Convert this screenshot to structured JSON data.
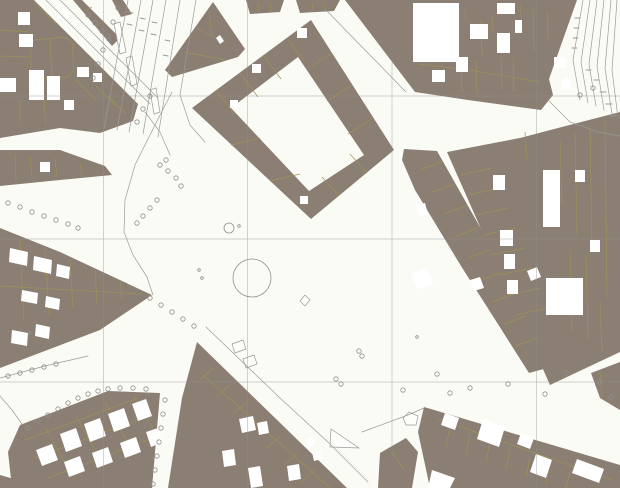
{
  "meta": {
    "width": 620,
    "height": 488,
    "description": "cadastral-city-map"
  },
  "colors": {
    "background": "#fbfbf6",
    "block_fill": "#8b7e73",
    "parcel_line": "#9d9356",
    "street_line": "#9a9a9a",
    "grid_line": "#8f8f8f",
    "building_fill": "#ffffff",
    "island_fill": "#fdfdf9",
    "circle_line": "#909090"
  },
  "grid": {
    "vertical_x": [
      103.5,
      247.5,
      392,
      536.5
    ],
    "horizontal_y": [
      96,
      239,
      382
    ]
  },
  "blocks": [
    {
      "name": "block-topleft-main",
      "points": "0,0 34,0 138,104 133,121 100,133 60,128 0,138"
    },
    {
      "name": "block-topleft-sliver",
      "points": "73,0 82,0 120,38 112,46"
    },
    {
      "name": "block-topleft-sliver2",
      "points": "112,0 123,0 132,14 121,17"
    },
    {
      "name": "block-triangle-top",
      "points": "213,2 245,49 238,57 172,77 165,70"
    },
    {
      "name": "block-ring-place",
      "points": "192,108 311,20 394,150 311,219",
      "hole": "231,108 298,57 364,155 309,191"
    },
    {
      "name": "block-top-strip-1",
      "points": "246,0 284,0 280,12 250,14"
    },
    {
      "name": "block-top-strip-2",
      "points": "296,0 340,0 334,11 300,13"
    },
    {
      "name": "block-topright-main",
      "points": "345,0 577,0 549,79 553,95 541,110 468,100 415,92"
    },
    {
      "name": "block-east-main",
      "points": "447,152 520,138 558,128 620,112 620,352 550,385"
    },
    {
      "name": "block-midright",
      "points": "404,149 437,151 549,349 551,367 529,373 461,266 415,190 402,160"
    },
    {
      "name": "block-bottomright-main",
      "points": "424,407 620,465 620,488 430,488 418,432"
    },
    {
      "name": "block-bottomright-sliver",
      "points": "591,373 620,362 620,410 600,398"
    },
    {
      "name": "block-bottomright-small",
      "points": "380,453 406,438 418,452 412,488 378,488"
    },
    {
      "name": "block-bottomcenter-wedge",
      "points": "197,342 347,488 168,488 182,398"
    },
    {
      "name": "block-bottomleft-main",
      "points": "20,425 108,391 160,393 152,488 12,488 8,452"
    },
    {
      "name": "block-bottomleft-corner",
      "points": "0,475 14,479 12,488 0,488"
    },
    {
      "name": "block-leftwedge-small",
      "points": "0,150 60,150 105,166 112,175 60,180 0,186"
    },
    {
      "name": "block-leftwedge-big",
      "points": "0,228 60,252 152,295 100,330 0,368"
    }
  ],
  "parcel_lines": [
    "34,40 64,37 72,42 74,70 68,77 38,79 31,72 31,45 34,40",
    "50,38 52,77",
    "0,30 28,32",
    "0,56 30,57",
    "34,2 56,24",
    "20,100 20,126",
    "44,100 46,124",
    "76,80 96,100",
    "96,86 116,106",
    "108,96 126,114",
    "216,90 234,114",
    "240,73 258,97",
    "263,55 281,79",
    "287,38 305,62",
    "332,53 307,69",
    "352,85 327,101",
    "373,118 348,134",
    "367,173 350,154",
    "339,196 322,177",
    "231,145 260,138",
    "270,181 300,174",
    "425,10 427,62",
    "440,5 441,58",
    "465,8 466,22",
    "481,20 482,56",
    "492,16 493,31",
    "520,5 521,18",
    "533,8 534,52",
    "547,12 548,40",
    "461,66 462,92",
    "476,60 477,94",
    "501,56 502,90",
    "513,58 514,92",
    "418,64 470,70 540,82",
    "197,28 228,44",
    "184,52 226,60",
    "209,12 212,36",
    "258,3 259,12",
    "270,2 271,12",
    "312,2 313,11",
    "324,2 325,10",
    "84,12 92,7",
    "96,26 104,21",
    "30,156 32,178",
    "55,158 57,177",
    "80,163 82,177",
    "15,154 16,182",
    "20,240 24,322",
    "45,250 49,315",
    "70,260 73,308",
    "95,270 97,303",
    "120,281 122,299",
    "0,286 140,294",
    "25,440 138,398",
    "34,458 148,416",
    "48,478 158,436",
    "45,427 68,468",
    "75,414 98,455",
    "105,402 128,443",
    "133,394 154,430",
    "213,368 200,380",
    "230,385 216,397",
    "247,402 233,414",
    "264,419 250,431",
    "281,436 267,448",
    "298,453 284,465",
    "315,470 301,482",
    "203,375 330,488",
    "460,175 492,168",
    "468,195 500,188",
    "476,215 508,208",
    "484,235 516,228",
    "492,255 524,248",
    "500,275 532,268",
    "508,295 540,288",
    "516,315 548,308",
    "560,140 562,205",
    "575,133 577,235",
    "590,126 592,250",
    "605,120 607,298",
    "570,250 572,332",
    "586,255 588,340",
    "600,300 602,352",
    "525,132 527,160",
    "420,170 442,162",
    "432,192 454,184",
    "444,214 466,206",
    "456,236 478,228",
    "468,258 490,250",
    "480,280 502,272",
    "492,302 514,294",
    "504,324 526,316",
    "516,346 538,338",
    "450,427 446,447",
    "470,434 466,454",
    "490,442 486,462",
    "510,449 506,469",
    "530,457 526,477",
    "550,464 546,484",
    "570,472 566,488",
    "438,419 612,480",
    "600,372 602,396",
    "392,452 404,470"
  ],
  "street_lines": [
    "172,92 155,125 135,165 125,200 124,232 133,255 147,277 153,295",
    "46,0 150,104",
    "60,0 158,98",
    "128,0 104,128",
    "141,0 117,130",
    "153,0 129,132",
    "166,0 143,134",
    "180,0 158,137",
    "196,0 180,95 190,125 205,142",
    "325,9 406,92",
    "206,327 280,398 330,444 368,482",
    "362,432 408,415 424,408",
    "583,0 573,60 580,100",
    "590,0 581,62 588,103",
    "597,0 589,64 596,106",
    "604,0 597,66 604,110",
    "611,0 605,68 612,114",
    "617,0 612,70 618,118",
    "548,100 570,122 598,132 620,136",
    "0,396 12,410 22,424",
    "0,378 45,366 88,356",
    "145,112 160,132 170,155"
  ],
  "tick_marks": [
    "128,12 133,13",
    "127,24 132,25",
    "140,18 145,19",
    "139,30 144,31",
    "152,22 157,23",
    "151,34 156,35",
    "165,40 170,41",
    "163,55 168,56",
    "575,18 580,18",
    "574,28 579,28",
    "573,38 578,38",
    "572,48 577,48",
    "586,70 591,70",
    "594,80 599,80",
    "600,92 606,92",
    "606,104 612,104",
    "610,116 616,116"
  ],
  "buildings": [
    "18,12 30,12 30,25 18,25",
    "57,8 68,8 68,18 57,18",
    "19,34 33,34 33,47 19,47",
    "29,70 44,70 44,100 29,100",
    "47,76 60,76 60,100 47,100",
    "77,67 89,67 89,77 77,77",
    "93,73 102,73 102,82 93,82",
    "0,78 16,78 16,92 0,92",
    "64,100 74,100 74,110 64,110",
    "216,38 220,35 224,41 220,44",
    "40,162 50,162 50,172 40,172",
    "252,64 261,64 261,73 252,73",
    "230,100 238,100 238,108 230,108",
    "297,28 307,28 307,38 297,38",
    "300,196 308,196 308,204 300,204",
    "413,3 459,3 459,62 413,62",
    "470,24 488,24 488,39 470,39",
    "497,33 510,33 510,53 497,53",
    "515,20 522,20 522,33 515,33",
    "554,57 565,57 565,68 554,68",
    "562,78 571,78 571,89 562,89",
    "456,57 468,57 468,72 456,72",
    "432,70 445,70 445,82 432,82",
    "497,3 515,3 515,14 497,14",
    "543,170 560,170 560,227 543,227",
    "493,175 505,175 505,190 493,190",
    "500,230 513,230 513,246 500,246",
    "504,254 515,254 515,269 504,269",
    "507,280 518,280 518,294 507,294",
    "546,278 583,278 583,315 546,315",
    "590,240 600,240 600,252 590,252",
    "575,170 585,170 585,182 575,182",
    "411,273 427,268 433,284 417,289",
    "416,205 425,203 428,214 419,216",
    "527,271 537,267 541,277 531,281",
    "470,280 480,277 484,288 474,291",
    "445,413 459,418 455,430 441,425",
    "483,419 505,427 499,447 477,439",
    "521,433 534,438 530,449 517,444",
    "536,454 552,460 546,478 530,472",
    "577,459 604,469 599,483 572,473",
    "432,470 455,478 450,488 428,488",
    "239,419 253,416 256,430 242,433",
    "257,423 267,421 269,433 259,435",
    "222,451 234,449 236,465 224,467",
    "248,468 260,466 263,486 251,488",
    "287,466 299,464 301,479 289,481",
    "312,452 320,450 322,459 314,461",
    "306,439 313,437 315,445 308,447",
    "60,434 76,428 82,446 66,452",
    "84,424 100,418 106,436 90,442",
    "108,414 124,408 130,426 114,432",
    "132,404 146,399 152,416 138,421",
    "36,450 52,444 58,460 42,466",
    "64,462 80,456 85,471 69,477",
    "92,453 108,447 113,462 97,468",
    "120,443 136,437 141,452 125,458",
    "146,432 158,428 163,442 151,447",
    "10,248 28,252 27,266 9,262",
    "34,256 52,260 51,274 33,270",
    "57,264 70,267 69,279 56,276",
    "22,290 38,293 37,304 21,301",
    "46,296 60,299 59,310 45,307",
    "12,330 28,333 27,346 11,343",
    "36,324 50,327 49,339 35,336"
  ],
  "islands": [
    "114,24 120,22 126,52 120,54",
    "126,58 132,56 137,84 131,86",
    "150,90 156,88 160,112 154,114",
    "232,344 243,340 246,349 235,353",
    "243,359 254,355 257,364 246,368",
    "403,418 409,412 418,416 416,425 406,425",
    "331,429 359,448 330,447",
    "300,301 305,295 310,300 305,306"
  ],
  "tree_circles": [
    [
      88,
      15
    ],
    [
      95,
      23
    ],
    [
      102,
      31
    ],
    [
      109,
      39
    ],
    [
      118,
      8
    ],
    [
      113,
      22
    ],
    [
      108,
      36
    ],
    [
      103,
      50
    ],
    [
      98,
      64
    ],
    [
      93,
      78
    ],
    [
      160,
      165
    ],
    [
      168,
      171
    ],
    [
      176,
      178
    ],
    [
      181,
      186
    ],
    [
      157,
      200
    ],
    [
      150,
      208
    ],
    [
      143,
      216
    ],
    [
      137,
      223
    ],
    [
      166,
      160
    ],
    [
      8,
      203
    ],
    [
      20,
      207
    ],
    [
      32,
      212
    ],
    [
      44,
      216
    ],
    [
      56,
      220
    ],
    [
      68,
      224
    ],
    [
      78,
      228
    ],
    [
      150,
      298
    ],
    [
      161,
      305
    ],
    [
      172,
      312
    ],
    [
      183,
      319
    ],
    [
      194,
      326
    ],
    [
      8,
      376
    ],
    [
      20,
      373
    ],
    [
      32,
      370
    ],
    [
      44,
      367
    ],
    [
      56,
      364
    ],
    [
      28,
      428
    ],
    [
      38,
      421
    ],
    [
      48,
      415
    ],
    [
      58,
      409
    ],
    [
      68,
      403
    ],
    [
      78,
      398
    ],
    [
      88,
      394
    ],
    [
      98,
      391
    ],
    [
      108,
      389
    ],
    [
      120,
      388
    ],
    [
      133,
      388
    ],
    [
      146,
      389
    ],
    [
      165,
      400
    ],
    [
      163,
      414
    ],
    [
      161,
      428
    ],
    [
      159,
      442
    ],
    [
      157,
      456
    ],
    [
      155,
      470
    ],
    [
      153,
      484
    ],
    [
      336,
      379
    ],
    [
      341,
      384
    ],
    [
      359,
      351
    ],
    [
      362,
      356
    ],
    [
      403,
      390
    ],
    [
      437,
      374
    ],
    [
      450,
      393
    ],
    [
      470,
      388
    ],
    [
      508,
      384
    ],
    [
      545,
      394
    ],
    [
      566,
      373
    ],
    [
      600,
      382
    ],
    [
      611,
      397
    ],
    [
      593,
      88
    ],
    [
      580,
      95
    ],
    [
      150,
      96
    ],
    [
      143,
      109
    ],
    [
      137,
      122
    ]
  ],
  "small_dots": [
    [
      417,
      337
    ],
    [
      199,
      270
    ],
    [
      202,
      278
    ],
    [
      239,
      226
    ],
    [
      30,
      333
    ]
  ],
  "fountain": {
    "cx": 252,
    "cy": 278,
    "r": 19
  },
  "pond_circle": {
    "cx": 229,
    "cy": 228,
    "r": 5
  }
}
